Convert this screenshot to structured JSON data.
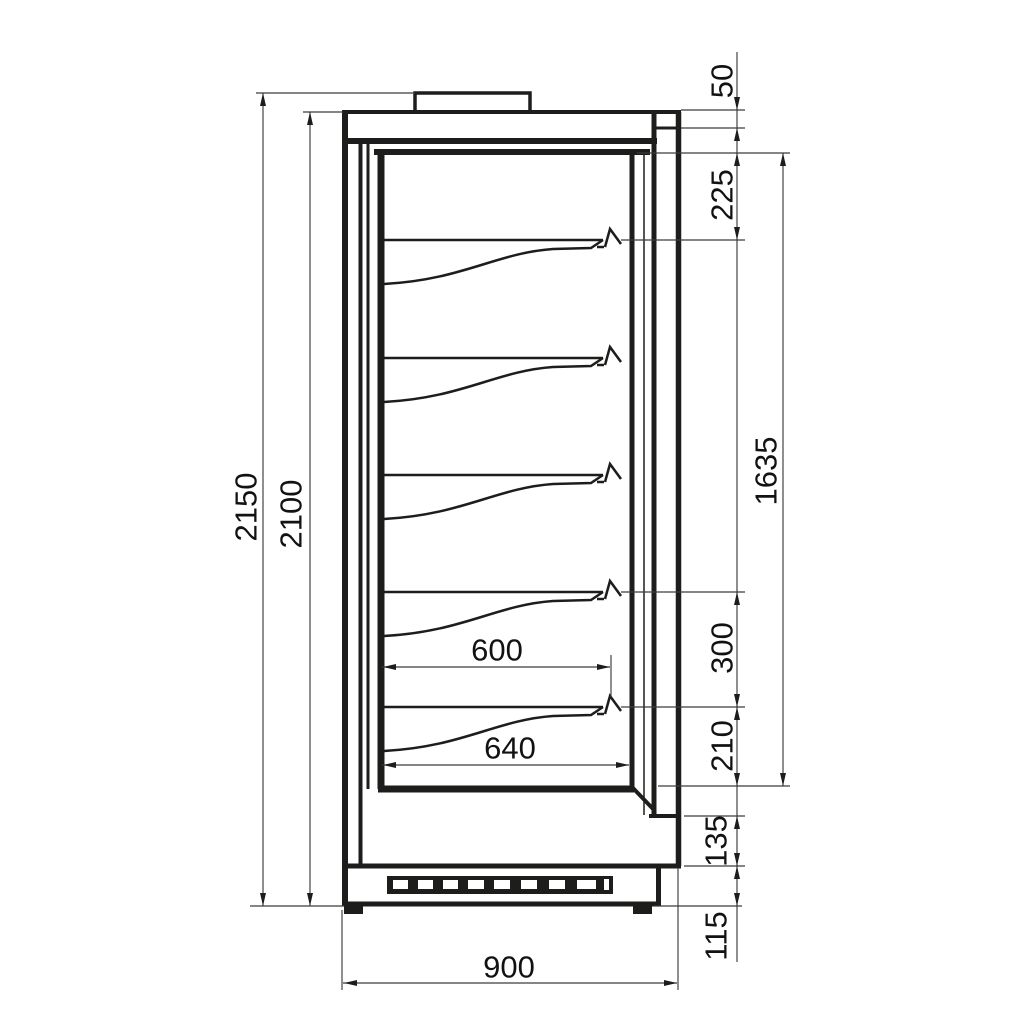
{
  "drawing": {
    "dimensions": {
      "overall_height": "2150",
      "body_height": "2100",
      "canopy_height": "50",
      "top_to_first_shelf": "225",
      "interior_height": "1635",
      "shelf_spacing": "300",
      "last_shelf_to_bottom": "210",
      "lower_front_height": "135",
      "plinth_height": "115",
      "shelf_depth": "600",
      "bottom_well_depth": "640",
      "overall_depth": "900"
    }
  }
}
